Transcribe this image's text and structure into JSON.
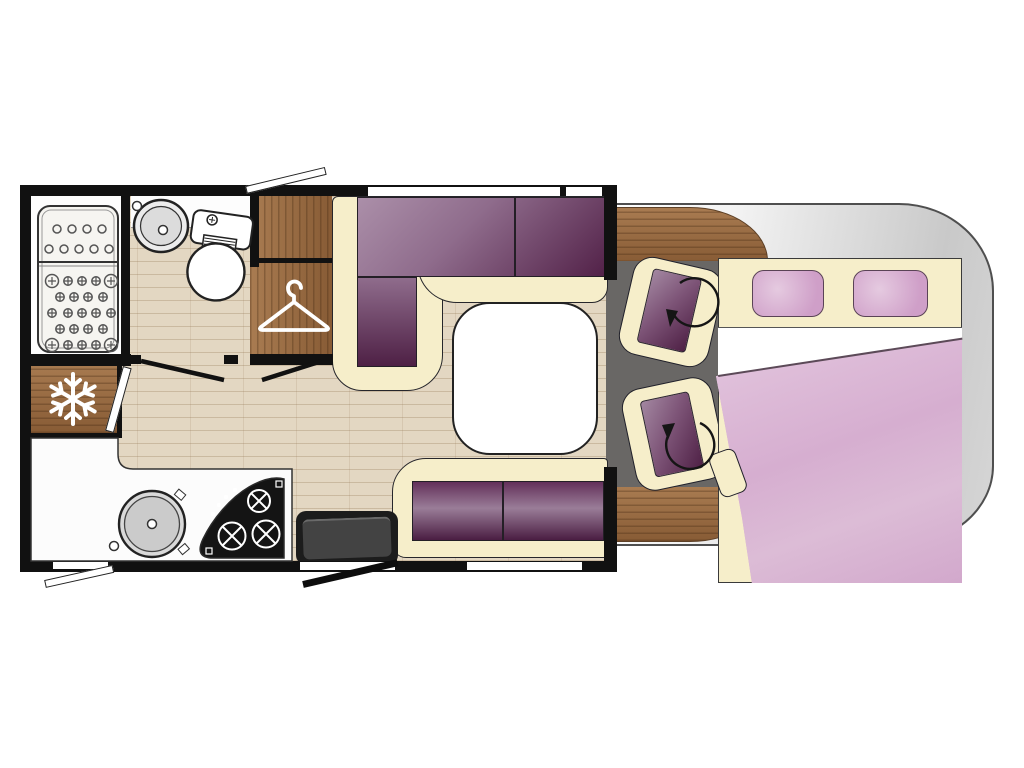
{
  "meta": {
    "title": "Motorhome floor plan",
    "view": "top-down"
  },
  "floorplan": {
    "vehicle": "motorhome floor plan",
    "areas": [
      "bathroom",
      "wardrobe",
      "kitchen",
      "lounge-dinette",
      "cab-lounge",
      "front-bed"
    ],
    "fixtures": [
      {
        "name": "shower-tray",
        "area": "bathroom"
      },
      {
        "name": "washbasin",
        "area": "bathroom"
      },
      {
        "name": "toilet",
        "area": "bathroom"
      },
      {
        "name": "wardrobe",
        "area": "wardrobe"
      },
      {
        "name": "fridge-freezer",
        "area": "kitchen"
      },
      {
        "name": "kitchen-sink",
        "area": "kitchen"
      },
      {
        "name": "hob",
        "area": "kitchen"
      },
      {
        "name": "entry-step",
        "area": "lounge-dinette"
      },
      {
        "name": "l-shaped-sofa",
        "area": "lounge-dinette"
      },
      {
        "name": "table",
        "area": "lounge-dinette"
      },
      {
        "name": "bench-sofa",
        "area": "lounge-dinette"
      },
      {
        "name": "swivel-seat-front",
        "area": "cab-lounge"
      },
      {
        "name": "swivel-seat-rear",
        "area": "cab-lounge"
      },
      {
        "name": "double-bed",
        "area": "front-bed"
      },
      {
        "name": "pillow",
        "area": "front-bed"
      },
      {
        "name": "pillow",
        "area": "front-bed"
      },
      {
        "name": "duvet",
        "area": "front-bed"
      }
    ],
    "icons": [
      {
        "name": "snowflake-icon",
        "meaning": "fridge-freezer"
      },
      {
        "name": "hanger-icon",
        "meaning": "wardrobe"
      },
      {
        "name": "rotation-arrow-icon",
        "meaning": "swivel seat rotates"
      },
      {
        "name": "rotation-arrow-icon",
        "meaning": "swivel seat rotates"
      }
    ]
  },
  "colors": {
    "wall": "#111111",
    "line": "#222222",
    "wood": "#9a6a40",
    "wood-dark": "#5e3a1c",
    "floor": "#e3d7c2",
    "floor-line": "#927552",
    "cream": "#f6eeca",
    "plum-l": "#ab8fa9",
    "plum-m": "#8f6c8c",
    "plum-d": "#522148",
    "pink": "#d6aed0",
    "pink-light": "#e5cae0",
    "body-light": "#ffffff",
    "body-gray": "#c9c9c9",
    "cab-floor": "#696765",
    "step": "#434343",
    "white": "#ffffff"
  }
}
